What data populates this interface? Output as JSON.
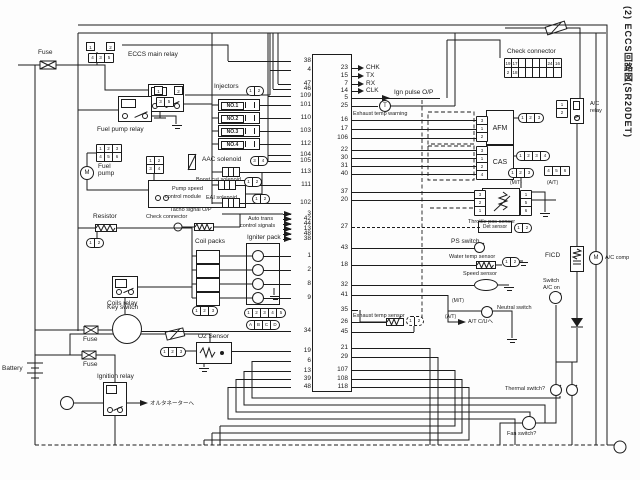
{
  "colors": {
    "ink": "#1c1c1c",
    "bg": "#fdfdfd"
  },
  "side_title": "(2) ECCS回路図(SR20DET)",
  "glyphs": {
    "m": "M",
    "t": "T"
  },
  "labels": {
    "fuse_a": "Fuse",
    "fuse_b": "Fuse",
    "fuse_c": "Fuse",
    "eccs_relay": "ECCS main relay",
    "fp_relay": "Fuel pump relay",
    "injectors": "Injectors",
    "fuel1": "Fuel",
    "fuel2": "pump",
    "pm1": "Pump speed",
    "pm2": "control module",
    "resistor": "Resistor",
    "check_left": "Check connector",
    "tacho": "Tacho signal O/P",
    "aac": "AAC solenoid",
    "boost": "Boost cut solenoid",
    "eai": "EAI solenoid",
    "at_sig1": "Auto trans",
    "at_sig2": "control signals",
    "coil_packs": "Coil packs",
    "igniter": "Igniter pack",
    "coils_relay": "Coils relay",
    "key_switch": "Key switch",
    "battery": "Battery",
    "ign_relay": "Ignition relay",
    "to_alt": "オルタネーターへ",
    "o2": "O2 Sensor",
    "exh_warn": "Exhaust temp warning",
    "ign_pulse": "Ign pulse O/P",
    "check_right": "Check connector",
    "ac_relay1": "A/C",
    "ac_relay2": "relay",
    "afm": "AFM",
    "cas": "CAS",
    "tps": "Throttle pos sensor",
    "det": "Det sensor",
    "ps": "PS switch",
    "water": "Water temp sensor",
    "speed": "Speed sensor",
    "neutral": "Neutral switch",
    "mt_a": "(M/T)",
    "at_a": "(A/T)",
    "mt_b": "(M/T)",
    "at_b": "(A/T)",
    "atcu": "A/T C/Uへ",
    "swac1": "Switch",
    "swac2": "A/C on",
    "ficd": "FICD",
    "accomp": "A/C comp",
    "exh_sensor": "Exhaust temp sensor",
    "thermal": "Thermal switch?",
    "fan": "Fan switch?"
  },
  "ecu": {
    "left_pins": [
      {
        "n": "38",
        "y": 61,
        "len": 63
      },
      {
        "n": "4",
        "y": 70,
        "len": 21
      },
      {
        "n": "47",
        "y": 84,
        "len": 13
      },
      {
        "n": "46",
        "y": 89,
        "len": 18
      },
      {
        "n": "109",
        "y": 96,
        "len": 23
      },
      {
        "n": "101",
        "y": 105,
        "len": 31
      },
      {
        "n": "110",
        "y": 118,
        "len": 31
      },
      {
        "n": "103",
        "y": 131,
        "len": 31
      },
      {
        "n": "112",
        "y": 144,
        "len": 31
      },
      {
        "n": "104",
        "y": 155,
        "len": 23
      },
      {
        "n": "105",
        "y": 161,
        "len": 23
      },
      {
        "n": "113",
        "y": 172,
        "len": 51
      },
      {
        "n": "111",
        "y": 185,
        "len": 55
      },
      {
        "n": "102",
        "y": 203,
        "len": 51
      },
      {
        "n": "3",
        "y": 214,
        "len": 8
      },
      {
        "n": "42",
        "y": 219,
        "len": 8
      },
      {
        "n": "44",
        "y": 224,
        "len": 8
      },
      {
        "n": "13",
        "y": 229,
        "len": 8
      },
      {
        "n": "48",
        "y": 234,
        "len": 8
      },
      {
        "n": "38",
        "y": 239,
        "len": 8
      },
      {
        "n": "1",
        "y": 256,
        "len": 28
      },
      {
        "n": "2",
        "y": 270,
        "len": 28
      },
      {
        "n": "8",
        "y": 284,
        "len": 28
      },
      {
        "n": "9",
        "y": 298,
        "len": 28
      },
      {
        "n": "34",
        "y": 331,
        "len": 151
      },
      {
        "n": "19",
        "y": 351,
        "len": 59
      },
      {
        "n": "6",
        "y": 361,
        "len": 39
      },
      {
        "n": "13",
        "y": 371,
        "len": 47
      },
      {
        "n": "39",
        "y": 379,
        "len": 55
      },
      {
        "n": "48",
        "y": 387,
        "len": 63
      }
    ],
    "right_pins": [
      {
        "n": "23",
        "y": 68,
        "len": 6,
        "label": "CHK"
      },
      {
        "n": "15",
        "y": 76,
        "len": 6,
        "label": "TX"
      },
      {
        "n": "7",
        "y": 84,
        "len": 6,
        "label": "RX"
      },
      {
        "n": "14",
        "y": 91,
        "len": 6,
        "label": "CLK"
      },
      {
        "n": "5",
        "y": 98,
        "len": 88
      },
      {
        "n": "25",
        "y": 106,
        "len": 26
      },
      {
        "n": "16",
        "y": 120,
        "len": 124
      },
      {
        "n": "17",
        "y": 129,
        "len": 124
      },
      {
        "n": "106",
        "y": 138,
        "len": 124
      },
      {
        "n": "22",
        "y": 150,
        "len": 124
      },
      {
        "n": "30",
        "y": 158,
        "len": 124
      },
      {
        "n": "31",
        "y": 166,
        "len": 124
      },
      {
        "n": "40",
        "y": 174,
        "len": 124
      },
      {
        "n": "37",
        "y": 192,
        "len": 122
      },
      {
        "n": "20",
        "y": 200,
        "len": 122
      },
      {
        "n": "27",
        "y": 227,
        "len": 128,
        "dash": true
      },
      {
        "n": "43",
        "y": 248,
        "len": 123
      },
      {
        "n": "18",
        "y": 265,
        "len": 124
      },
      {
        "n": "32",
        "y": 285,
        "len": 122
      },
      {
        "n": "41",
        "y": 295,
        "len": 96
      },
      {
        "n": "35",
        "y": 310,
        "len": 6
      },
      {
        "n": "26",
        "y": 322,
        "len": 34
      },
      {
        "n": "45",
        "y": 332,
        "len": 62
      },
      {
        "n": "21",
        "y": 348,
        "len": 78
      },
      {
        "n": "29",
        "y": 357,
        "len": 86
      },
      {
        "n": "107",
        "y": 370,
        "len": 103
      },
      {
        "n": "108",
        "y": 379,
        "len": 110
      },
      {
        "n": "118",
        "y": 387,
        "len": 117
      }
    ]
  },
  "injector_rows": [
    {
      "t": "NO.1",
      "y": 105
    },
    {
      "t": "NO.2",
      "y": 118
    },
    {
      "t": "NO.3",
      "y": 131
    },
    {
      "t": "NO.4",
      "y": 144
    }
  ],
  "igniter_letters": [
    {
      "t": "D",
      "y": 256
    },
    {
      "t": "C",
      "y": 270
    },
    {
      "t": "B",
      "y": 284
    },
    {
      "t": "A",
      "y": 298
    }
  ],
  "connectors": {
    "eccs_pair": [
      "1",
      "2"
    ],
    "eccs_tri": [
      "4",
      "3",
      "5"
    ],
    "fpr_pair": [
      "1",
      "2"
    ],
    "fpr_tri": [
      "3",
      "5"
    ],
    "inj": [
      "1",
      "2"
    ],
    "aac": [
      "3",
      "4"
    ],
    "boost": [
      "1",
      "2"
    ],
    "eai": [
      "1",
      "2"
    ],
    "fp_top": [
      "1",
      "2",
      "3"
    ],
    "fp_bot": [
      "4",
      "5",
      "6"
    ],
    "mod_top": [
      "1",
      "2"
    ],
    "mod_bot": [
      "3",
      "4"
    ],
    "res": [
      "1",
      "2"
    ],
    "coil": [
      "1",
      "2",
      "3"
    ],
    "ign5": [
      "1",
      "2",
      "3",
      "4",
      "5"
    ],
    "ign_abcd": [
      "A",
      "B",
      "C",
      "D"
    ],
    "o2": [
      "1",
      "2",
      "3"
    ],
    "chk_top": [
      "19",
      "17",
      "",
      "",
      "",
      "",
      "24",
      "16"
    ],
    "chk_bot": [
      "2",
      "18",
      "",
      "",
      "",
      "",
      "",
      ""
    ],
    "ac_relay": [
      "1",
      "2"
    ],
    "afm_cells": [
      "3",
      "1",
      "2"
    ],
    "afm_conn": [
      "1",
      "2",
      "3"
    ],
    "cas_cells": [
      "3",
      "1",
      "2",
      "4"
    ],
    "cas_conn": [
      "1",
      "2",
      "3",
      "4"
    ],
    "mt": [
      "1",
      "2",
      "3"
    ],
    "at": [
      "4",
      "5",
      "6"
    ],
    "tps_left": [
      "3",
      "2",
      "1"
    ],
    "tps_right": [
      "1",
      "5",
      "6"
    ],
    "det": [
      "1",
      "2"
    ],
    "water": [
      "1",
      "2"
    ],
    "exh": [
      "1",
      "2"
    ]
  }
}
